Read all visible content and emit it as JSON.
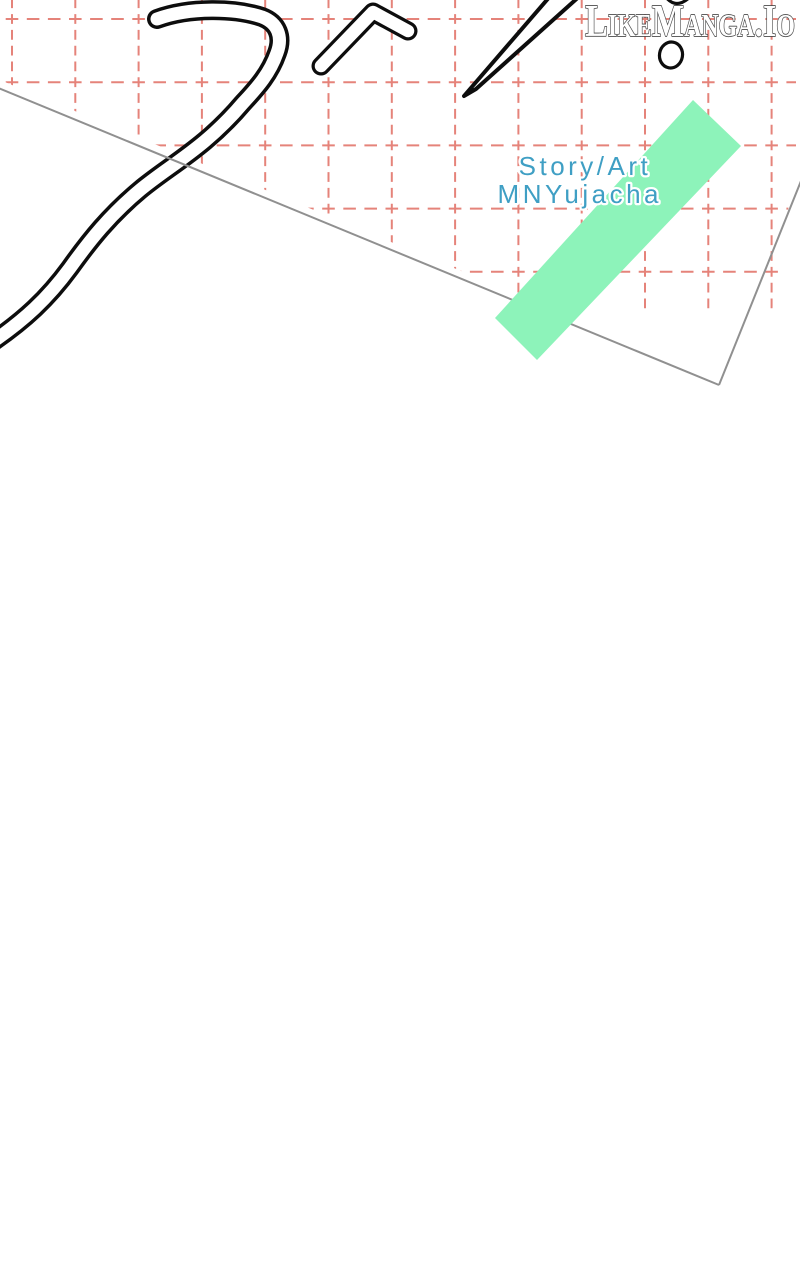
{
  "watermark": {
    "text": "LikeManga.Io"
  },
  "credits": {
    "role": "Story/Art",
    "author": "MNYujacha"
  },
  "colors": {
    "grid": "#e5837a",
    "sheet_edge": "#909090",
    "tape": "#8df3ba",
    "credit_text": "#3f9fc4",
    "ink": "#0d0d0d",
    "logo_fill": "#ffffff",
    "logo_outline": "#4a4a4a"
  }
}
